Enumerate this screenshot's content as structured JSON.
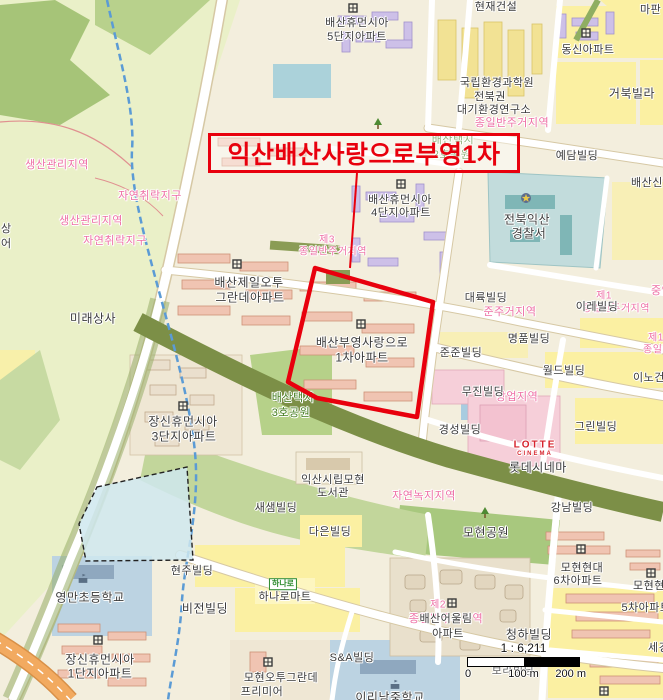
{
  "highlight": {
    "label": "익산배산사랑으로부영1차"
  },
  "scale": {
    "ratio": "1 : 6,211",
    "ticks": [
      "0",
      "100 m",
      "200 m"
    ]
  },
  "colors": {
    "highlight_red": "#e8000d",
    "zoning_pink": "#ee6fa5",
    "park_green_text": "#447d20",
    "road_yellow": "#fbf0a2",
    "water_blue": "#5b9bd5",
    "olive_band": "#7c8f47",
    "lotte_red": "#d6232d"
  },
  "labels": [
    {
      "t": "현재건설",
      "x": 496,
      "y": 6
    },
    {
      "t": "마판",
      "x": 640,
      "y": 9,
      "a": "l"
    },
    {
      "t": "배산휴먼시아",
      "x": 357,
      "y": 22
    },
    {
      "t": "5단지아파트",
      "x": 357,
      "y": 36
    },
    {
      "t": "동신아파트",
      "x": 588,
      "y": 49
    },
    {
      "t": "국립환경과학원",
      "x": 497,
      "y": 82
    },
    {
      "t": "전북권",
      "x": 490,
      "y": 96
    },
    {
      "t": "대기환경연구소",
      "x": 494,
      "y": 109
    },
    {
      "t": "종일반주거지역",
      "x": 512,
      "y": 122,
      "c": "p"
    },
    {
      "t": "거북빌라",
      "x": 632,
      "y": 93,
      "s": 12
    },
    {
      "t": "예담빌딩",
      "x": 577,
      "y": 155
    },
    {
      "t": "생산관리지역",
      "x": 57,
      "y": 164,
      "c": "p"
    },
    {
      "t": "자연취락지구",
      "x": 150,
      "y": 195,
      "c": "p"
    },
    {
      "t": "생산관리지역",
      "x": 91,
      "y": 220,
      "c": "p"
    },
    {
      "t": "자연취락지구",
      "x": 115,
      "y": 240,
      "c": "p"
    },
    {
      "t": "상",
      "x": 1,
      "y": 228,
      "a": "l"
    },
    {
      "t": "어",
      "x": 1,
      "y": 243,
      "a": "l"
    },
    {
      "t": "미래상사",
      "x": 93,
      "y": 318,
      "s": 12
    },
    {
      "t": "배산제일오투",
      "x": 249,
      "y": 282,
      "s": 12
    },
    {
      "t": "그란데아파트",
      "x": 250,
      "y": 297,
      "s": 12
    },
    {
      "t": "제3",
      "x": 327,
      "y": 238,
      "c": "p",
      "s": 10
    },
    {
      "t": "종일반주거지역",
      "x": 333,
      "y": 250,
      "c": "p",
      "s": 10
    },
    {
      "t": "배산휴먼시아",
      "x": 400,
      "y": 199
    },
    {
      "t": "4단지아파트",
      "x": 401,
      "y": 212
    },
    {
      "t": "전북익산",
      "x": 527,
      "y": 219,
      "s": 12
    },
    {
      "t": "경찰서",
      "x": 529,
      "y": 233,
      "s": 12
    },
    {
      "t": "배산신협",
      "x": 631,
      "y": 182,
      "a": "l"
    },
    {
      "t": "대륙빌딩",
      "x": 486,
      "y": 297
    },
    {
      "t": "준주거지역",
      "x": 510,
      "y": 311,
      "c": "p"
    },
    {
      "t": "제1",
      "x": 604,
      "y": 294,
      "c": "p",
      "s": 10
    },
    {
      "t": "종일반주거지역",
      "x": 616,
      "y": 307,
      "c": "p",
      "s": 10,
      "z": 1
    },
    {
      "t": "이레빌딩",
      "x": 597,
      "y": 306,
      "z": 2
    },
    {
      "t": "중앙",
      "x": 651,
      "y": 290,
      "c": "p",
      "a": "l"
    },
    {
      "t": "명품빌딩",
      "x": 529,
      "y": 338
    },
    {
      "t": "준준빌딩",
      "x": 461,
      "y": 352
    },
    {
      "t": "월드빌딩",
      "x": 564,
      "y": 370
    },
    {
      "t": "이노건설",
      "x": 633,
      "y": 377,
      "a": "l"
    },
    {
      "t": "제1",
      "x": 648,
      "y": 336,
      "c": "p",
      "s": 10,
      "a": "l"
    },
    {
      "t": "종일반주거",
      "x": 643,
      "y": 348,
      "c": "p",
      "s": 10,
      "a": "l"
    },
    {
      "t": "상업지역",
      "x": 517,
      "y": 396,
      "c": "p",
      "z": 1
    },
    {
      "t": "무진빌딩",
      "x": 483,
      "y": 391,
      "z": 2
    },
    {
      "t": "배산부영사랑으로",
      "x": 362,
      "y": 342,
      "s": 12
    },
    {
      "t": "1차아파트",
      "x": 362,
      "y": 357,
      "s": 12
    },
    {
      "t": "경성빌딩",
      "x": 460,
      "y": 429
    },
    {
      "t": "그린빌딩",
      "x": 596,
      "y": 426
    },
    {
      "t": "LOTTE",
      "x": 535,
      "y": 445,
      "c": "lotte",
      "s": 10
    },
    {
      "t": "CINEMA",
      "x": 535,
      "y": 454,
      "c": "lotte",
      "s": 6
    },
    {
      "t": "롯데시네마",
      "x": 538,
      "y": 467,
      "s": 12
    },
    {
      "t": "강남빌딩",
      "x": 572,
      "y": 507
    },
    {
      "t": "자연녹지지역",
      "x": 424,
      "y": 495,
      "c": "p"
    },
    {
      "t": "익산시립모현",
      "x": 333,
      "y": 479
    },
    {
      "t": "도서관",
      "x": 333,
      "y": 492
    },
    {
      "t": "배산택지",
      "x": 293,
      "y": 397,
      "c": "g"
    },
    {
      "t": "3호공원",
      "x": 291,
      "y": 412,
      "c": "g"
    },
    {
      "t": "장신휴먼시아",
      "x": 183,
      "y": 421,
      "s": 12
    },
    {
      "t": "3단지아파트",
      "x": 184,
      "y": 436,
      "s": 12
    },
    {
      "t": "새샘빌딩",
      "x": 276,
      "y": 507
    },
    {
      "t": "다은빌딩",
      "x": 330,
      "y": 531
    },
    {
      "t": "현주빌딩",
      "x": 192,
      "y": 570
    },
    {
      "t": "비전빌딩",
      "x": 205,
      "y": 608,
      "s": 12
    },
    {
      "t": "하나로마트",
      "x": 285,
      "y": 596
    },
    {
      "t": "영만초등학교",
      "x": 90,
      "y": 597,
      "s": 12
    },
    {
      "t": "장신휴먼시아",
      "x": 100,
      "y": 659,
      "s": 12
    },
    {
      "t": "1단지아파트",
      "x": 100,
      "y": 673,
      "s": 12
    },
    {
      "t": "S&A빌딩",
      "x": 352,
      "y": 657
    },
    {
      "t": "이리남중학교",
      "x": 390,
      "y": 697,
      "s": 12
    },
    {
      "t": "모현오투그란데",
      "x": 281,
      "y": 677
    },
    {
      "t": "프리미어",
      "x": 262,
      "y": 691
    },
    {
      "t": "모현공원",
      "x": 486,
      "y": 532,
      "s": 12
    },
    {
      "t": "제2",
      "x": 438,
      "y": 603,
      "c": "p",
      "s": 10
    },
    {
      "t": "종일반주거지역",
      "x": 446,
      "y": 618,
      "c": "p",
      "z": 1
    },
    {
      "t": "배산어울림",
      "x": 446,
      "y": 618,
      "z": 2
    },
    {
      "t": "아파트",
      "x": 448,
      "y": 633,
      "z": 2
    },
    {
      "t": "청하빌딩",
      "x": 529,
      "y": 634,
      "s": 12
    },
    {
      "t": "모현현대",
      "x": 582,
      "y": 567
    },
    {
      "t": "6차아파트",
      "x": 578,
      "y": 580
    },
    {
      "t": "모현현대",
      "x": 633,
      "y": 585,
      "a": "l"
    },
    {
      "t": "5차아파트",
      "x": 646,
      "y": 607
    },
    {
      "t": "세경",
      "x": 648,
      "y": 647,
      "a": "l"
    },
    {
      "t": "보라빌딩",
      "x": 513,
      "y": 670,
      "c": "gr"
    },
    {
      "t": "배산택지",
      "x": 453,
      "y": 139,
      "c": "g"
    },
    {
      "t": "2호공원",
      "x": 452,
      "y": 154,
      "c": "g"
    }
  ],
  "icons": [
    {
      "k": "apartment",
      "x": 353,
      "y": 8
    },
    {
      "k": "apartment",
      "x": 586,
      "y": 33
    },
    {
      "k": "apartment",
      "x": 237,
      "y": 264
    },
    {
      "k": "apartment",
      "x": 401,
      "y": 184
    },
    {
      "k": "apartment",
      "x": 361,
      "y": 324
    },
    {
      "k": "apartment",
      "x": 183,
      "y": 406
    },
    {
      "k": "apartment",
      "x": 98,
      "y": 640
    },
    {
      "k": "apartment",
      "x": 452,
      "y": 603
    },
    {
      "k": "apartment",
      "x": 581,
      "y": 549
    },
    {
      "k": "apartment",
      "x": 651,
      "y": 573
    },
    {
      "k": "apartment",
      "x": 268,
      "y": 662
    },
    {
      "k": "apartment",
      "x": 604,
      "y": 691
    },
    {
      "k": "police",
      "x": 526,
      "y": 198
    },
    {
      "k": "school",
      "x": 83,
      "y": 578
    },
    {
      "k": "school",
      "x": 395,
      "y": 684
    },
    {
      "k": "tree",
      "x": 485,
      "y": 513
    },
    {
      "k": "tree",
      "x": 378,
      "y": 124
    },
    {
      "k": "hanaro",
      "x": 283,
      "y": 584,
      "t": "하나로"
    }
  ]
}
